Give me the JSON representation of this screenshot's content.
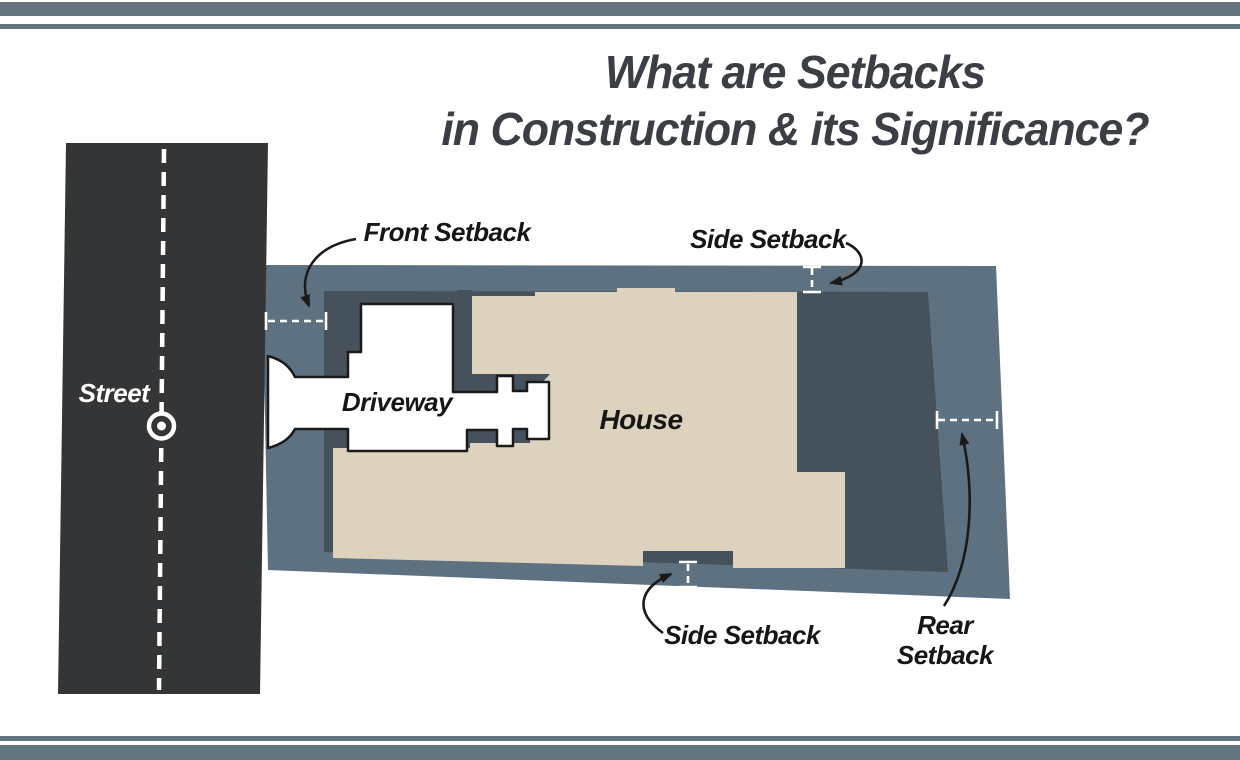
{
  "title": {
    "line1": "What are Setbacks",
    "line2": "in Construction & its Significance?"
  },
  "labels": {
    "street": "Street",
    "driveway": "Driveway",
    "house": "House",
    "front_setback": "Front Setback",
    "side_setback_top": "Side Setback",
    "side_setback_bottom": "Side Setback",
    "rear_setback_line1": "Rear",
    "rear_setback_line2": "Setback"
  },
  "colors": {
    "street": "#333537",
    "lot": "#5e7181",
    "buildable": "#45525c",
    "house": "#ddd2bd",
    "driveway": "#ffffff",
    "outline": "#1a1a1a",
    "accent_bar": "#64757f",
    "title_text": "#3b3e45",
    "label_text": "#161616",
    "marking": "#ffffff"
  }
}
